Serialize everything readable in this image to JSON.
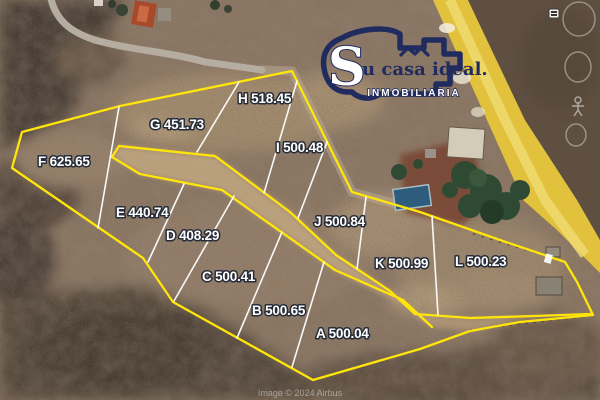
{
  "map": {
    "watermark": "Image © 2024 Airbus"
  },
  "logo": {
    "initial": "S",
    "name_rest": "u casa ideal.",
    "subtitle": "INMOBILIARIA",
    "navy": "#202b5f"
  },
  "lots": [
    {
      "id": "A",
      "label": "A 500.04"
    },
    {
      "id": "B",
      "label": "B 500.65"
    },
    {
      "id": "C",
      "label": "C 500.41"
    },
    {
      "id": "D",
      "label": "D 408.29"
    },
    {
      "id": "E",
      "label": "E 440.74"
    },
    {
      "id": "F",
      "label": "F 625.65"
    },
    {
      "id": "G",
      "label": "G 451.73"
    },
    {
      "id": "H",
      "label": "H 518.45"
    },
    {
      "id": "I",
      "label": "I 500.48"
    },
    {
      "id": "J",
      "label": "J 500.84"
    },
    {
      "id": "K",
      "label": "K 500.99"
    },
    {
      "id": "L",
      "label": "L 500.23"
    }
  ],
  "colors": {
    "boundary_yellow": "#ffe50a",
    "divider_white": "#ffffff",
    "highlight_road": "#e2c23c",
    "logo_navy": "#202b5f"
  }
}
